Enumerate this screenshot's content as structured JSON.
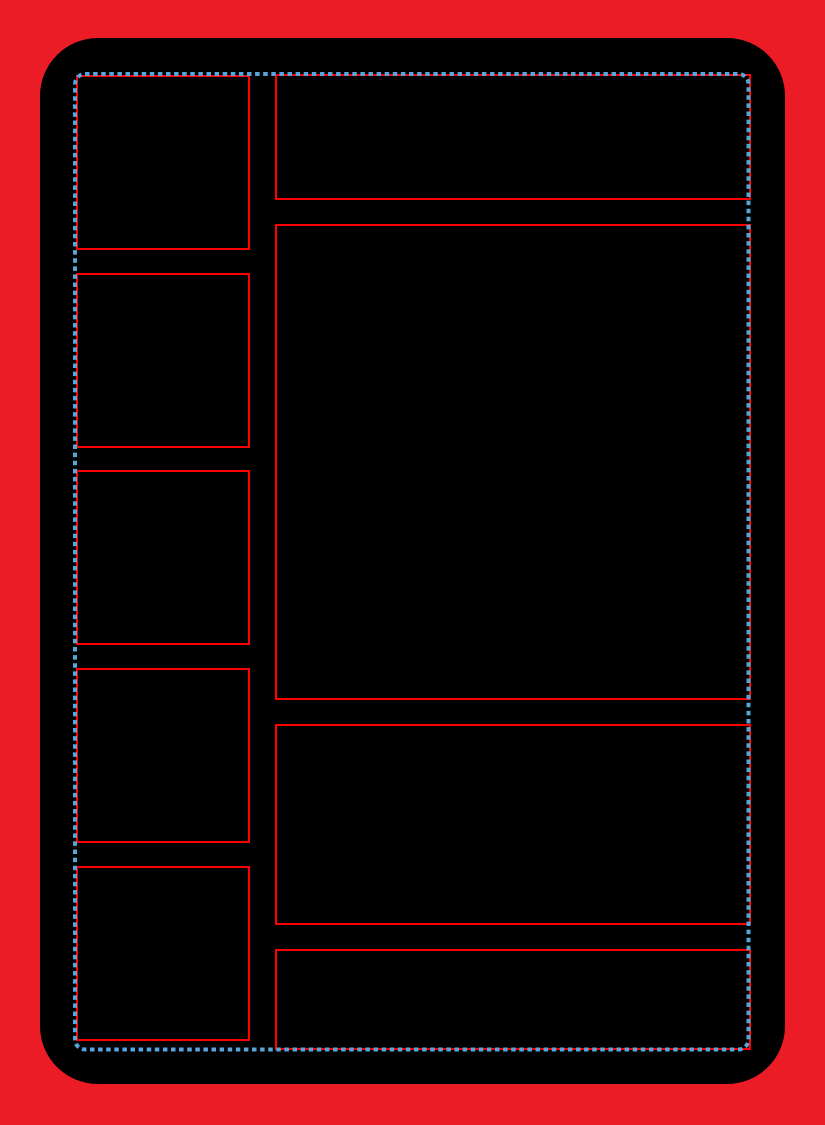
{
  "palette": {
    "bleed_red": "#EC1C27",
    "frame_red": "#FF0000",
    "card_black": "#000000",
    "safe_guide_blue": "#55A7DB"
  },
  "template": {
    "left_column_panel_count": 5,
    "right_column_panel_count": 4,
    "panels": {
      "left": [
        {
          "name": "left-panel-1"
        },
        {
          "name": "left-panel-2"
        },
        {
          "name": "left-panel-3"
        },
        {
          "name": "left-panel-4"
        },
        {
          "name": "left-panel-5"
        }
      ],
      "right": [
        {
          "name": "header-panel"
        },
        {
          "name": "main-panel"
        },
        {
          "name": "lower-panel"
        },
        {
          "name": "bottom-panel"
        }
      ]
    }
  }
}
